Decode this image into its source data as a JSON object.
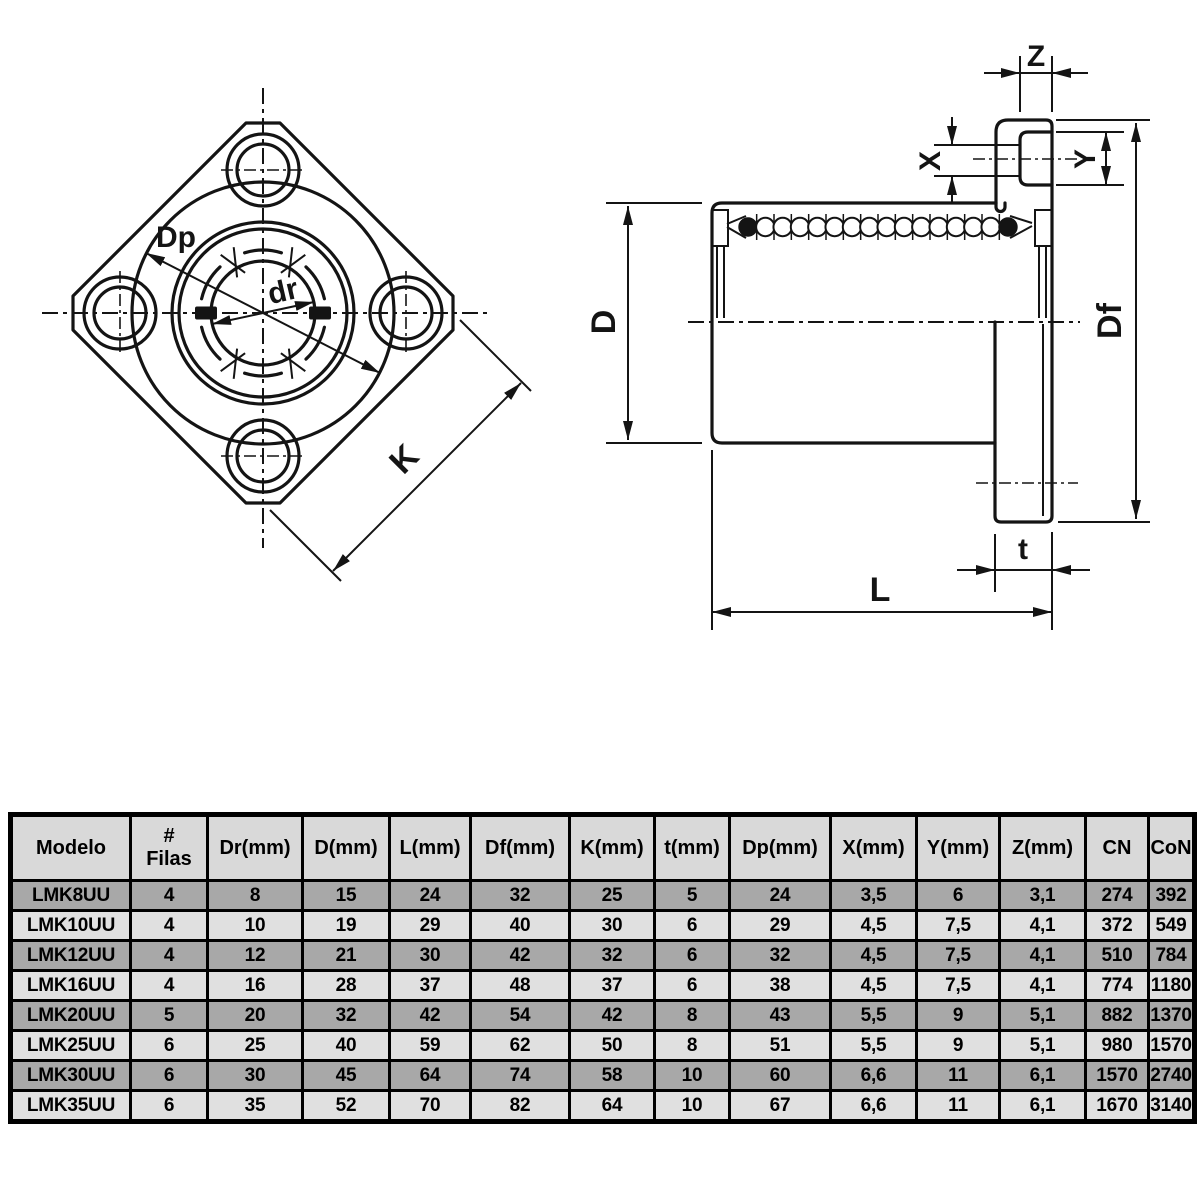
{
  "drawing": {
    "front_view": {
      "label_dp": "Dp",
      "label_dr": "dr",
      "label_k": "K"
    },
    "side_view": {
      "label_z": "Z",
      "label_x": "X",
      "label_y": "Y",
      "label_d": "D",
      "label_df": "Df",
      "label_t": "t",
      "label_l": "L"
    }
  },
  "table": {
    "headers": [
      "Modelo",
      "#\nFilas",
      "Dr(mm)",
      "D(mm)",
      "L(mm)",
      "Df(mm)",
      "K(mm)",
      "t(mm)",
      "Dp(mm)",
      "X(mm)",
      "Y(mm)",
      "Z(mm)",
      "CN",
      "CoN"
    ],
    "rows": [
      [
        "LMK8UU",
        "4",
        "8",
        "15",
        "24",
        "32",
        "25",
        "5",
        "24",
        "3,5",
        "6",
        "3,1",
        "274",
        "392"
      ],
      [
        "LMK10UU",
        "4",
        "10",
        "19",
        "29",
        "40",
        "30",
        "6",
        "29",
        "4,5",
        "7,5",
        "4,1",
        "372",
        "549"
      ],
      [
        "LMK12UU",
        "4",
        "12",
        "21",
        "30",
        "42",
        "32",
        "6",
        "32",
        "4,5",
        "7,5",
        "4,1",
        "510",
        "784"
      ],
      [
        "LMK16UU",
        "4",
        "16",
        "28",
        "37",
        "48",
        "37",
        "6",
        "38",
        "4,5",
        "7,5",
        "4,1",
        "774",
        "1180"
      ],
      [
        "LMK20UU",
        "5",
        "20",
        "32",
        "42",
        "54",
        "42",
        "8",
        "43",
        "5,5",
        "9",
        "5,1",
        "882",
        "1370"
      ],
      [
        "LMK25UU",
        "6",
        "25",
        "40",
        "59",
        "62",
        "50",
        "8",
        "51",
        "5,5",
        "9",
        "5,1",
        "980",
        "1570"
      ],
      [
        "LMK30UU",
        "6",
        "30",
        "45",
        "64",
        "74",
        "58",
        "10",
        "60",
        "6,6",
        "11",
        "6,1",
        "1570",
        "2740"
      ],
      [
        "LMK35UU",
        "6",
        "35",
        "52",
        "70",
        "82",
        "64",
        "10",
        "67",
        "6,6",
        "11",
        "6,1",
        "1670",
        "3140"
      ]
    ],
    "row_shading": [
      "dark",
      "light",
      "dark",
      "light",
      "dark",
      "light",
      "dark",
      "light"
    ]
  },
  "colors": {
    "line": "#141414",
    "table_border": "#000000",
    "header_bg": "#d9d9d9",
    "row_light": "#e0e0e0",
    "row_dark": "#a8a8a8",
    "background": "#ffffff"
  }
}
